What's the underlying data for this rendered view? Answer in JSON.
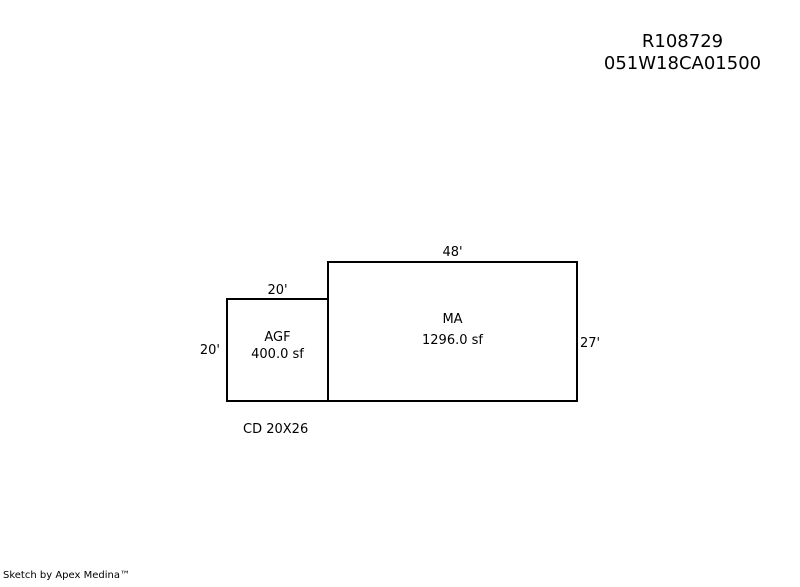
{
  "header": {
    "account_id": "R108729",
    "taxlot_id": "051W18CA01500"
  },
  "sketch": {
    "areas": [
      {
        "code": "MA",
        "sqft_label": "1296.0 sf",
        "top_dim": "48'",
        "right_dim": "27'"
      },
      {
        "code": "AGF",
        "sqft_label": "400.0 sf",
        "top_dim": "20'",
        "left_dim": "20'"
      }
    ],
    "note": "CD 20X26"
  },
  "footer": {
    "credit": "Sketch by Apex Medina™"
  },
  "colors": {
    "background": "#ffffff",
    "line": "#000000",
    "text": "#000000"
  }
}
